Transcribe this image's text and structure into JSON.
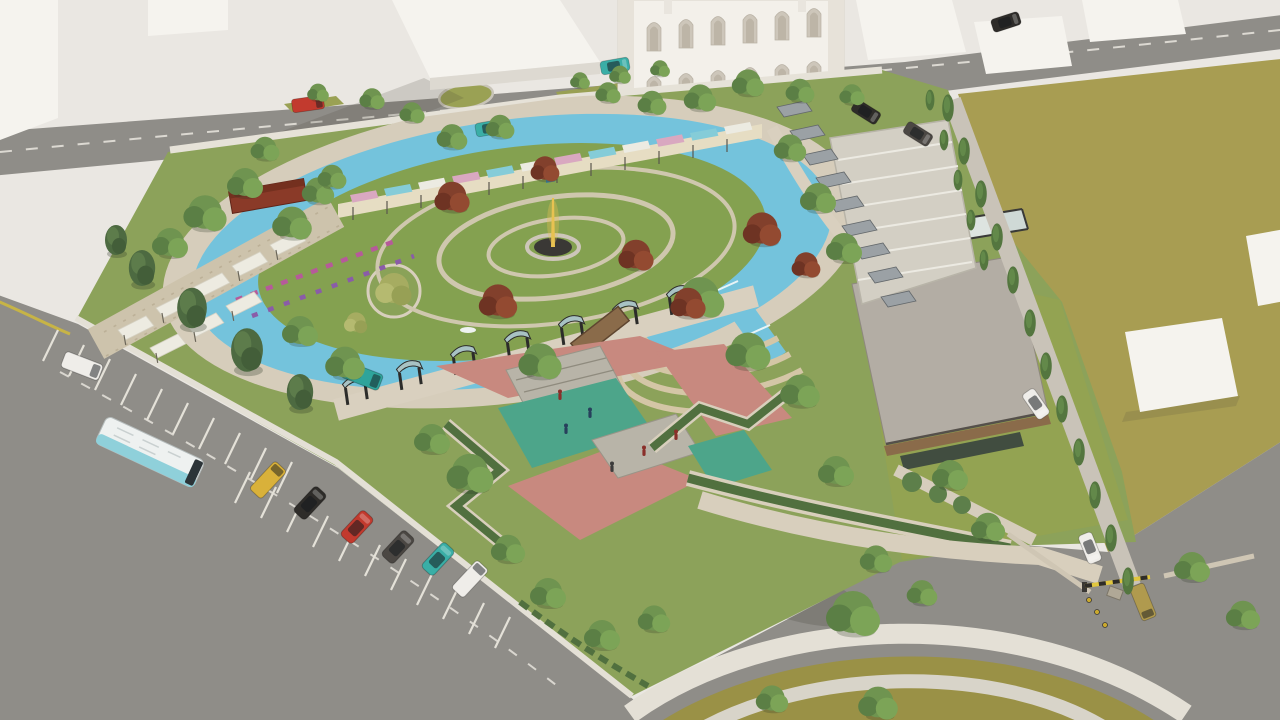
{
  "meta": {
    "title": "Aerial 3D architectural rendering of an urban park masterplan",
    "description": "Bird's-eye concept render: oval lake ringed by a canal around a circular lawn with a golden fountain and red maples; curved gallery pavilion with pink and cyan panels; terraced gardens with white shade sails; pink paved plaza with teal play courts; flat-roofed cafe building with glass canopy; shaded parking rows; tree-lined streets with parked cars and a bus; roundabout and gated entrance with striped barrier."
  },
  "colors": {
    "paper": "#eae7e2",
    "block_face": "#f5f3ee",
    "block_side": "#ddd9d1",
    "road": "#8f8d88",
    "sidewalk": "#e4e0d6",
    "promenade": "#d6cdbb",
    "path_tan": "#d9d0bf",
    "park_grass": "#8ca25a",
    "lawn": "#84a150",
    "dry_grass": "#a89d52",
    "olive_grass": "#9a9146",
    "water": "#74c3dc",
    "plaza_pink": "#c8897f",
    "court_teal": "#4da58a",
    "platform": "#b8b4a8",
    "hedge": "#51703f",
    "roof_gravel": "#b3ada4",
    "glass_canopy": "#cfd9d6",
    "wood": "#8a6b4a",
    "canopy_gray": "#9ba1a5",
    "gallery_cream": "#e6ddc3",
    "panel_pink": "#d9a8c0",
    "panel_cyan": "#85ccd8",
    "door_blue": "#3f86a0",
    "kiosk_red": "#8a3a28",
    "fountain_gold": "#e8c251",
    "fountain_base": "#3a3835",
    "bus_white": "#eef1f0",
    "bus_cyan": "#8fd0da",
    "van_teal": "#2fa49b",
    "car_yellow": "#d9b13a",
    "car_red": "#c23a2e",
    "car_teal": "#3aaea6",
    "car_black": "#2e2c29",
    "car_gray": "#4b4743",
    "car_white": "#efede9",
    "truck_tan": "#b09a4e",
    "barrier_yellow": "#e0c63e",
    "flower_pink": "#b65a9a",
    "flower_purple": "#8a5ca8"
  }
}
